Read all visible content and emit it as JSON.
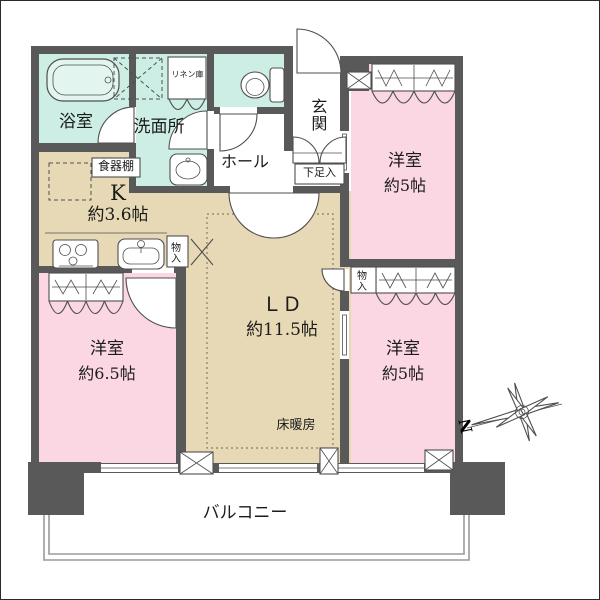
{
  "colors": {
    "wall": "#595959",
    "room_pink": "#fbd7e3",
    "ldk_beige": "#e7d9b6",
    "wet_mint": "#cdeee4",
    "fixture_mint": "#e2f5ee",
    "line": "#4f4f4f",
    "balcony_line": "#9a9a9a",
    "text": "#1b1b1b"
  },
  "labels": {
    "bath": "浴室",
    "washroom": "洗面所",
    "linen": "リネン庫",
    "hall": "ホール",
    "entrance": "玄関",
    "shoe_cabinet": "下足入",
    "cupboard": "食器棚",
    "kitchen_k": "K",
    "kitchen_area": "約3.6帖",
    "ld": "ＬＤ",
    "ld_area": "約11.5帖",
    "floor_heating": "床暖房",
    "storage_left": "物入",
    "storage_right": "物入",
    "room_top_right": "洋室",
    "room_top_right_area": "約5帖",
    "room_bottom_right": "洋室",
    "room_bottom_right_area": "約5帖",
    "room_bottom_left": "洋室",
    "room_bottom_left_area": "約6.5帖",
    "balcony": "バルコニー",
    "compass_n": "N"
  }
}
